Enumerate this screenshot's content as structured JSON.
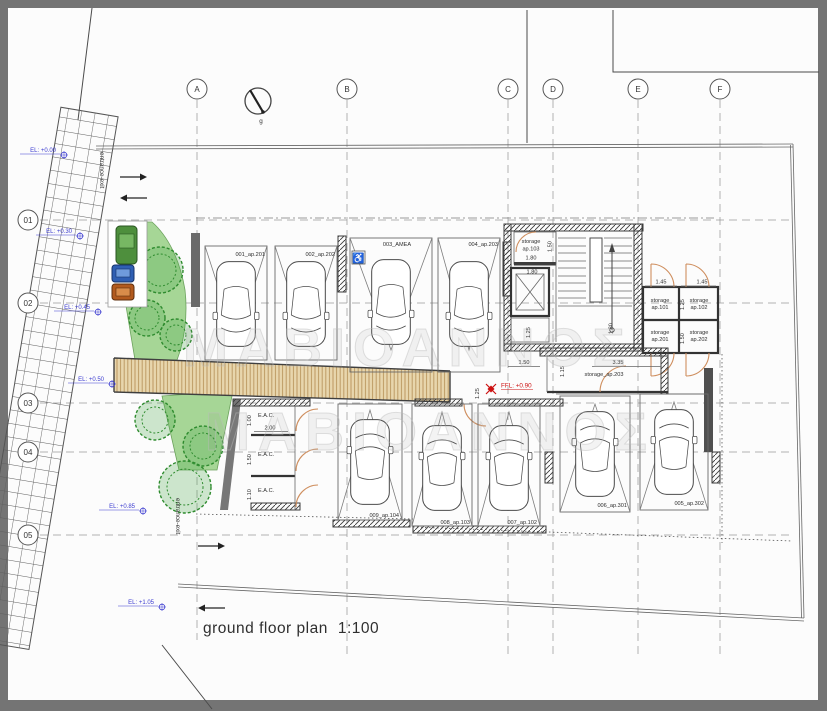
{
  "caption": {
    "title": "ground floor plan",
    "scale": "1:100"
  },
  "grid": {
    "columns": [
      "A",
      "B",
      "C",
      "D",
      "E",
      "F"
    ],
    "rows": [
      "01",
      "02",
      "03",
      "04",
      "05"
    ]
  },
  "north": {
    "label": "g"
  },
  "entrance": {
    "top": "entrance-exit",
    "bottom": "entrance-exit"
  },
  "levels": [
    "EL: +0.00",
    "EL: +0.30",
    "EL: +0.45",
    "EL: +0.50",
    "EL: +0.85",
    "EL: +1.05"
  ],
  "ffl": {
    "label": "FFL: +0.90"
  },
  "parking": {
    "top": [
      {
        "label": "001_ap.201"
      },
      {
        "label": "002_ap.202"
      },
      {
        "label": "003_AMEA",
        "icon_char": "♿"
      },
      {
        "label": "004_ap.203"
      }
    ],
    "bottom": [
      {
        "label": "009_ap.104"
      },
      {
        "label": "008_ap.103"
      },
      {
        "label": "007_ap.102"
      },
      {
        "label": "006_ap.301"
      },
      {
        "label": "005_ap.302"
      }
    ]
  },
  "rooms": {
    "storage103": [
      "storage",
      "ap.103"
    ],
    "storage101": [
      "storage",
      "ap.101"
    ],
    "storage102": [
      "storage",
      "ap.102"
    ],
    "storage201": [
      "storage",
      "ap.201"
    ],
    "storage202": [
      "storage",
      "ap.202"
    ],
    "storage203": "storage_ap.203",
    "eac": [
      "E.A.C.",
      "E.A.C.",
      "E.A.C."
    ]
  },
  "dims": {
    "s103_w": "1.80",
    "s103_h": "1.50",
    "elev_w": "1.80",
    "nook_h": "1.25",
    "stair_h": "1.80",
    "s101_w": "1.45",
    "s102_w": "1.45",
    "row1_h": "1.25",
    "row2_h": "1.50",
    "corr_w": "1.50",
    "s203_w": "3.35",
    "s203_h": "1.15",
    "ffl_h": "1.25",
    "eac1_h": "1.00",
    "eac1_w": "2.00",
    "eac2_h": "1.50",
    "eac3_h": "1.10"
  },
  "watermark": {
    "line1": "ΜΑΒΙΟΑΝΝΟΣ",
    "line2": "ΜΑΒΙΟΑΝΝΟΣ"
  },
  "colors": {
    "green_area": "#a6d696",
    "tree": "#2e8b2e",
    "deck": "#e8d6ad",
    "deck_stripe": "#bd9a63",
    "door_arc": "#cf8f5f",
    "level_blue": "#3c3cd0",
    "ffl_red": "#cc1111",
    "frame_gray": "#747474"
  }
}
